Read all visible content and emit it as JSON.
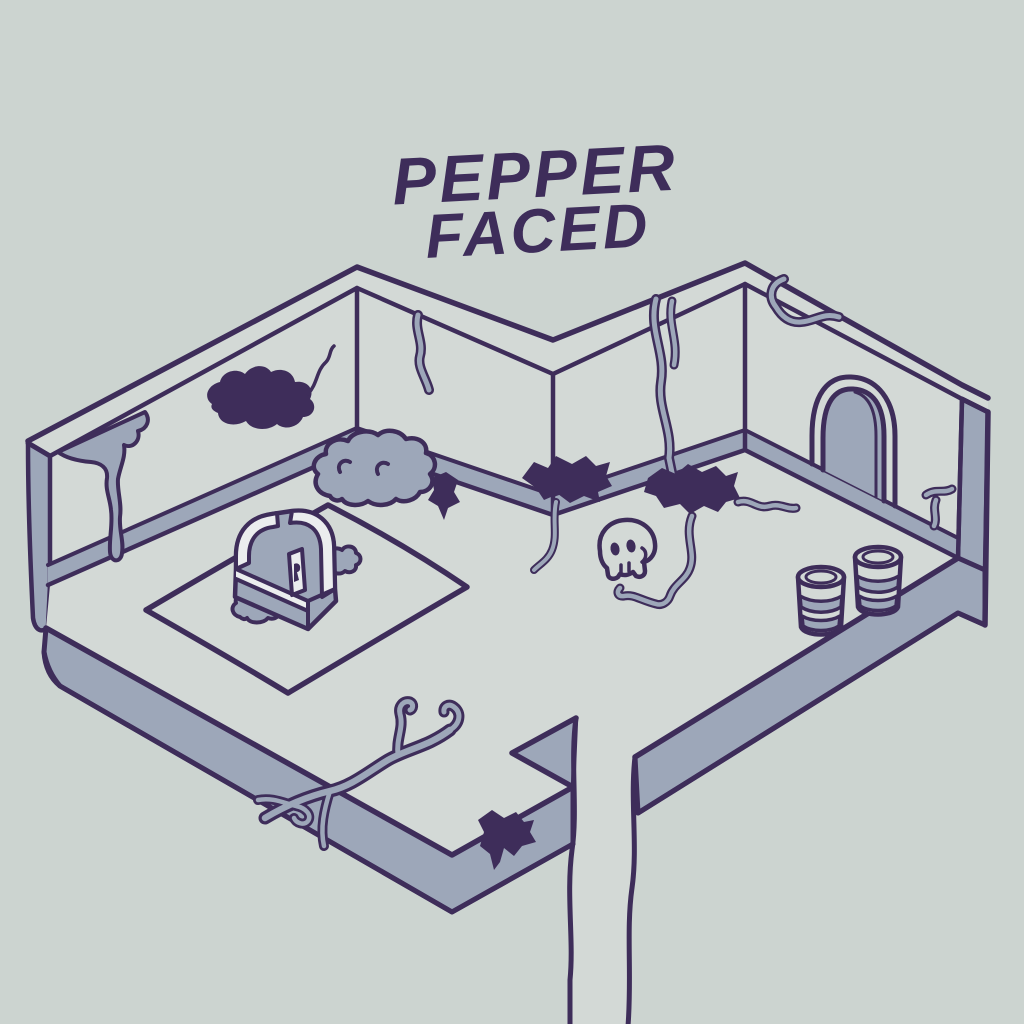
{
  "title": {
    "line1": "PEPPER",
    "line2": "FACED"
  },
  "colors": {
    "background": "#ccd4d0",
    "surface": "#d3d9d6",
    "shade": "#9da7b9",
    "trim": "#ebedee",
    "ink": "#3e2d5a"
  },
  "scene": {
    "description": "Hand-drawn isometric dungeon room illustration",
    "objects": [
      {
        "name": "treasure-chest",
        "location": "left room, on rug"
      },
      {
        "name": "rug",
        "location": "left room floor"
      },
      {
        "name": "skull",
        "location": "center floor near wall stain"
      },
      {
        "name": "barrel",
        "count": 2,
        "location": "right room floor"
      },
      {
        "name": "arched-door",
        "location": "right wall"
      },
      {
        "name": "exit-path",
        "location": "bottom center, leading off-screen"
      },
      {
        "name": "cloud-puff",
        "count": 3
      },
      {
        "name": "dark-stain",
        "count": 5
      },
      {
        "name": "crack",
        "count": 7
      }
    ]
  }
}
